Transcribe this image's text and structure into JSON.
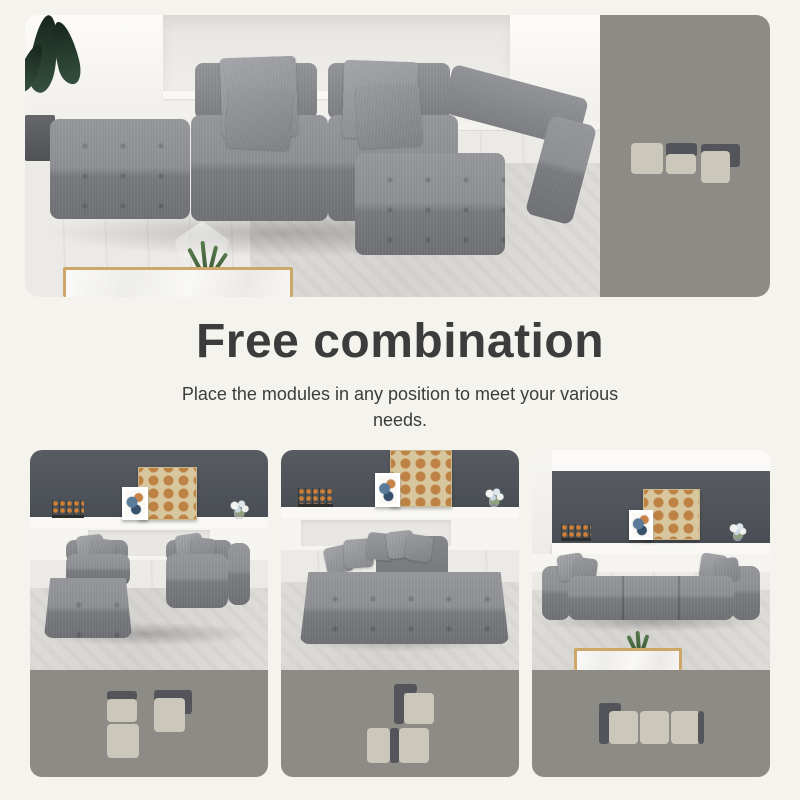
{
  "page": {
    "background": "#f4f3ee"
  },
  "headline": {
    "title": "Free combination",
    "subtitle": "Place the modules in any position to meet your various needs."
  },
  "colors": {
    "page_bg": "#f4f3ee",
    "panel_bg": "#8d8b86",
    "module_light": "#cbc8bb",
    "module_dark": "#54555a",
    "title_text": "#3c3c3c",
    "wall_dark": "#50555b",
    "sofa_gray": "#8a8c90",
    "gold_trim": "#cda767"
  },
  "hero": {
    "diagram": {
      "w": 109,
      "h": 40,
      "parts": [
        {
          "kind": "back",
          "x": 35,
          "y": 0,
          "w": 31,
          "h": 14
        },
        {
          "kind": "back",
          "x": 70,
          "y": 1,
          "w": 39,
          "h": 23
        },
        {
          "kind": "seat",
          "x": 0,
          "y": 0,
          "w": 32,
          "h": 31
        },
        {
          "kind": "seat",
          "x": 35,
          "y": 11,
          "w": 30,
          "h": 20
        },
        {
          "kind": "seat",
          "x": 70,
          "y": 8,
          "w": 29,
          "h": 32
        }
      ]
    }
  },
  "variants": [
    {
      "diagram": {
        "w": 85,
        "h": 68,
        "parts": [
          {
            "kind": "back",
            "x": 0,
            "y": 1,
            "w": 30,
            "h": 9
          },
          {
            "kind": "back",
            "x": 47,
            "y": 0,
            "w": 38,
            "h": 24
          },
          {
            "kind": "seat",
            "x": 0,
            "y": 9,
            "w": 30,
            "h": 23
          },
          {
            "kind": "seat",
            "x": 0,
            "y": 34,
            "w": 32,
            "h": 34
          },
          {
            "kind": "seat",
            "x": 47,
            "y": 8,
            "w": 31,
            "h": 34
          }
        ]
      }
    },
    {
      "diagram": {
        "w": 67,
        "h": 79,
        "parts": [
          {
            "kind": "back",
            "x": 27,
            "y": 0,
            "w": 23,
            "h": 9
          },
          {
            "kind": "back",
            "x": 27,
            "y": 0,
            "w": 10,
            "h": 40
          },
          {
            "kind": "seat",
            "x": 37,
            "y": 9,
            "w": 30,
            "h": 31
          },
          {
            "kind": "seat",
            "x": 0,
            "y": 44,
            "w": 23,
            "h": 35
          },
          {
            "kind": "back",
            "x": 23,
            "y": 44,
            "w": 9,
            "h": 35
          },
          {
            "kind": "seat",
            "x": 32,
            "y": 44,
            "w": 30,
            "h": 35
          }
        ]
      }
    },
    {
      "diagram": {
        "w": 105,
        "h": 41,
        "parts": [
          {
            "kind": "back",
            "x": 0,
            "y": 0,
            "w": 22,
            "h": 10
          },
          {
            "kind": "back",
            "x": 0,
            "y": 0,
            "w": 10,
            "h": 41
          },
          {
            "kind": "seat",
            "x": 10,
            "y": 8,
            "w": 29,
            "h": 33
          },
          {
            "kind": "seat",
            "x": 41,
            "y": 8,
            "w": 29,
            "h": 33
          },
          {
            "kind": "seat",
            "x": 72,
            "y": 8,
            "w": 29,
            "h": 33
          },
          {
            "kind": "back",
            "x": 99,
            "y": 8,
            "w": 6,
            "h": 33
          }
        ]
      }
    }
  ]
}
